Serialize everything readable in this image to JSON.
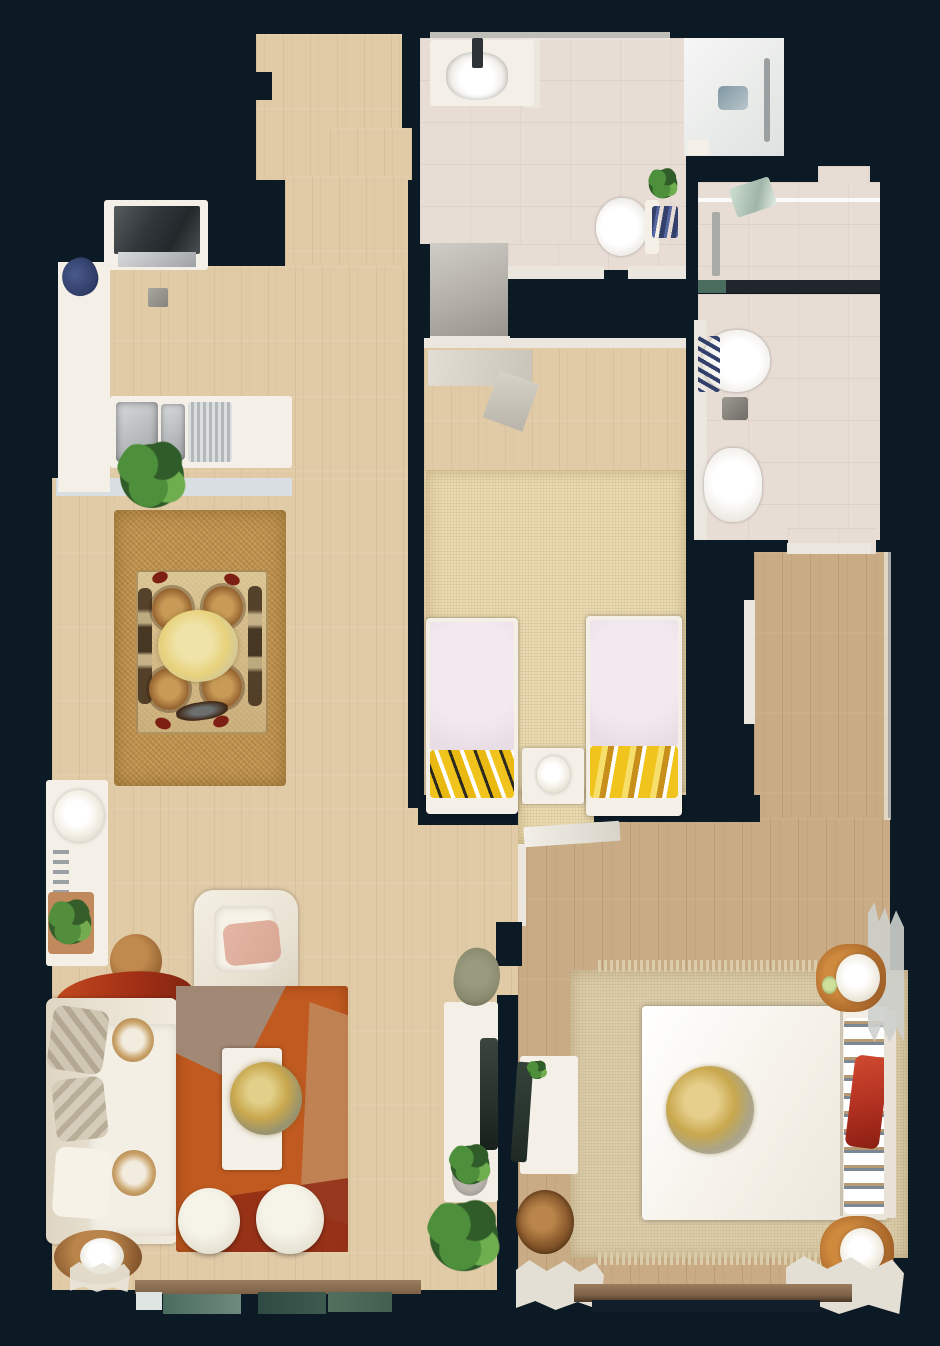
{
  "scene": {
    "type": "floorplan-top-down-3d-scan",
    "description": "Top-down dollhouse floor plan view of a furnished apartment on a dark navy background",
    "rooms": [
      {
        "name": "entry-hallway"
      },
      {
        "name": "kitchen"
      },
      {
        "name": "main-bathroom"
      },
      {
        "name": "ensuite-bathroom"
      },
      {
        "name": "kids-bedroom"
      },
      {
        "name": "dining-area"
      },
      {
        "name": "living-room"
      },
      {
        "name": "master-bedroom"
      },
      {
        "name": "balcony"
      }
    ],
    "furniture": [
      "stove",
      "kitchen-sink",
      "kitchen-counter",
      "kitchen-plant",
      "bathroom-vanity",
      "toilet",
      "walk-in-shower",
      "shower-drain",
      "bidet",
      "dining-table",
      "rattan-chairs",
      "jute-rug",
      "console-table",
      "table-lamp",
      "succulent-tray",
      "leather-pouf",
      "armchair",
      "sofa",
      "red-throw",
      "orange-area-rug",
      "coffee-table",
      "brass-bowl",
      "ottoman-poufs",
      "side-stool-plant",
      "desk",
      "desk-chair",
      "potted-plants",
      "dried-plant",
      "twin-bed",
      "kids-nightstand",
      "sisal-rug",
      "double-bed",
      "gold-throw",
      "nightstand-with-lamp",
      "dresser",
      "wicker-basket",
      "bedroom-rug",
      "curtains",
      "window-band"
    ]
  },
  "palette": {
    "bg": "#0c1a26",
    "wood1": "#e1cba7",
    "wood2": "#c9ab85",
    "tile": "#e8ddd5",
    "shower": "#edeeec",
    "grayShower": "#b3afa8",
    "wall": "#ebe7de",
    "wallCool": "#d9dee2",
    "jute": "#bf9350",
    "sisal": "#e9dab2",
    "mrug": "#dccdaa",
    "orange": "#c05a20",
    "rugDarkRed": "#8f2c16",
    "rugTaupe": "#9f8e80",
    "rugTan": "#c08a5c",
    "cream": "#e9e2d3",
    "white": "#f4f0e7",
    "steel": "#b9bcbe",
    "stove": "#31373a",
    "plant": "#4e8f3c",
    "plantDark": "#2f5c28",
    "plantGray": "#8a8a6e",
    "bedPink": "#e9dde5",
    "pillowYellow": "#f0c41c",
    "gold": "#c9a84e",
    "goldPale": "#e7d27c",
    "redAccent": "#a33016",
    "redPillow": "#b03020",
    "navyItem": "#32406b",
    "woodBrown": "#a8662a",
    "basket": "#8a5a2d",
    "pouf": "#94612f",
    "blush": "#d8a794",
    "darkChair": "#27302b",
    "teal1": "#4a6c5f",
    "teal2": "#2f4a42",
    "teal3": "#53705f",
    "winBrown": "#7d6248"
  }
}
